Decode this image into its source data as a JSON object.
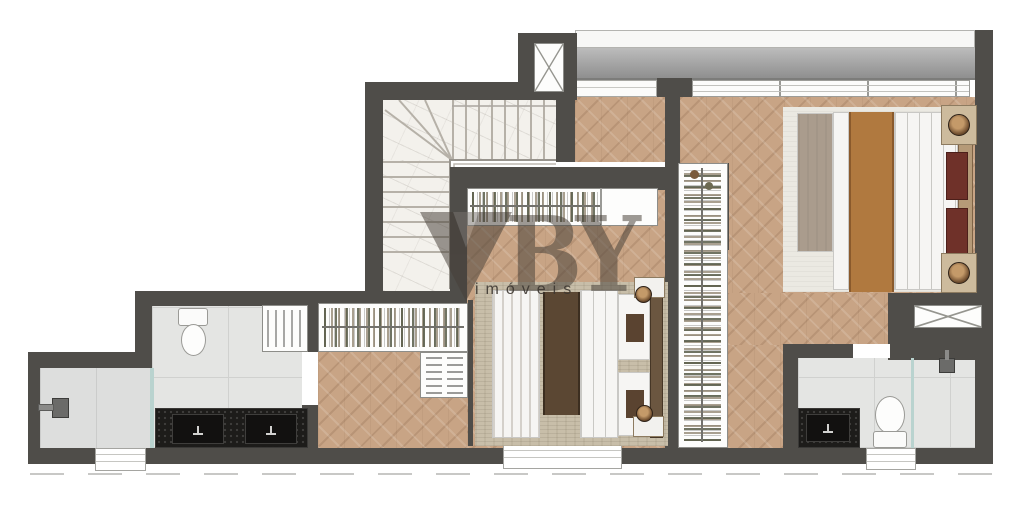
{
  "watermark": {
    "brand_by": "BY",
    "subtitle": "imóveis"
  },
  "palette": {
    "wall": "#4f4d49",
    "wood": "#c8a485",
    "marble": "#f3f1ec",
    "tile": "#e4e5e3",
    "slab": "#8f8f8f",
    "vanity": "#1d1c1a",
    "pillow": "#6f3129",
    "throw_caramel": "#b0793f",
    "throw_brown": "#5b4733",
    "rug_light": "#ebe9e2",
    "rug_mid": "#c8bea9",
    "glass": "#b9d3cf"
  }
}
